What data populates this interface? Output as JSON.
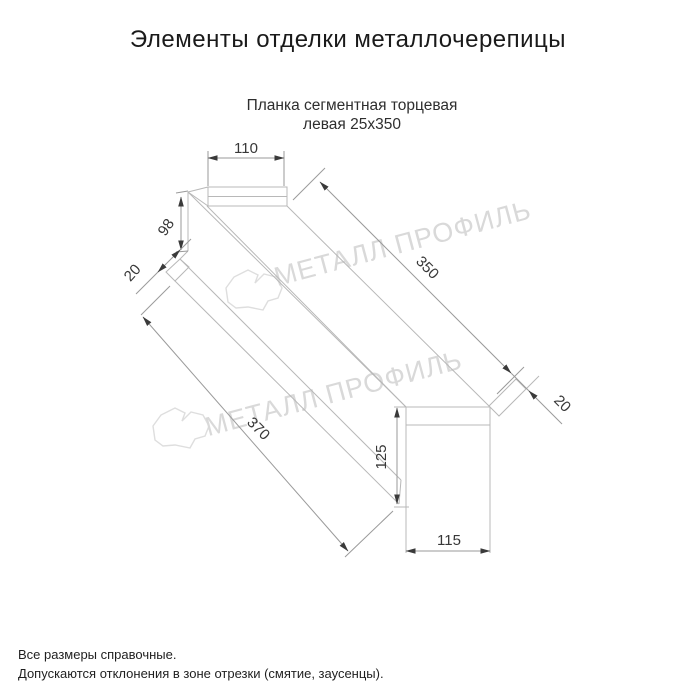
{
  "header": {
    "title": "Элементы отделки металлочерепицы"
  },
  "drawing": {
    "subtitle_line1": "Планка сегментная торцевая",
    "subtitle_line2": "левая 25х350",
    "dims": {
      "top_width": "110",
      "left_height": "98",
      "left_flange": "20",
      "top_length": "350",
      "bottom_length": "370",
      "right_flange": "20",
      "end_height": "125",
      "end_width": "115"
    }
  },
  "watermark": {
    "text": "МЕТАЛЛ ПРОФИЛЬ",
    "color": "#d9d9d9"
  },
  "notes": {
    "line1": "Все размеры справочные.",
    "line2": "Допускаются отклонения в зоне отрезки (смятие, заусенцы)."
  },
  "colors": {
    "background": "#ffffff",
    "part_line": "#b8b8b8",
    "dim_line": "#9a9a9a",
    "arrow": "#3a3a3a",
    "dim_text": "#383838",
    "title_text": "#1a1a1a",
    "note_text": "#1f1f1f"
  }
}
